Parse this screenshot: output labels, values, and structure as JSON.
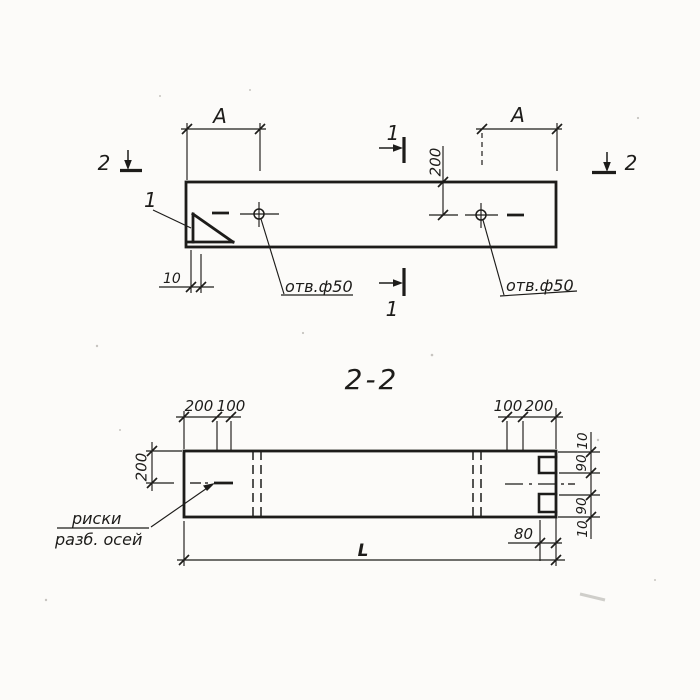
{
  "drawing": {
    "section_title": "2-2",
    "top_view": {
      "dim_A_left": "А",
      "dim_A_right": "А",
      "dim_200_to_hole": "200",
      "dim_10_wall": "10",
      "hole_label_left": "отв.ф50",
      "hole_label_right": "отв.ф50",
      "detail_mark": "1",
      "section1_mark_top": "1",
      "section1_mark_bottom": "1",
      "section2_mark_left": "2",
      "section2_mark_right": "2"
    },
    "section_view": {
      "dims_top_left": [
        "200",
        "100"
      ],
      "dims_top_right": [
        "100",
        "200"
      ],
      "dim_left_height": "200",
      "dims_right": [
        "10",
        "90",
        "90",
        "10"
      ],
      "dim_notch_depth": "80",
      "dim_length": "L",
      "axes_label_line1": "риски",
      "axes_label_line2": "разб. осей"
    },
    "colors": {
      "ink": "#1d1c1a",
      "paper": "#fcfbf9"
    }
  }
}
